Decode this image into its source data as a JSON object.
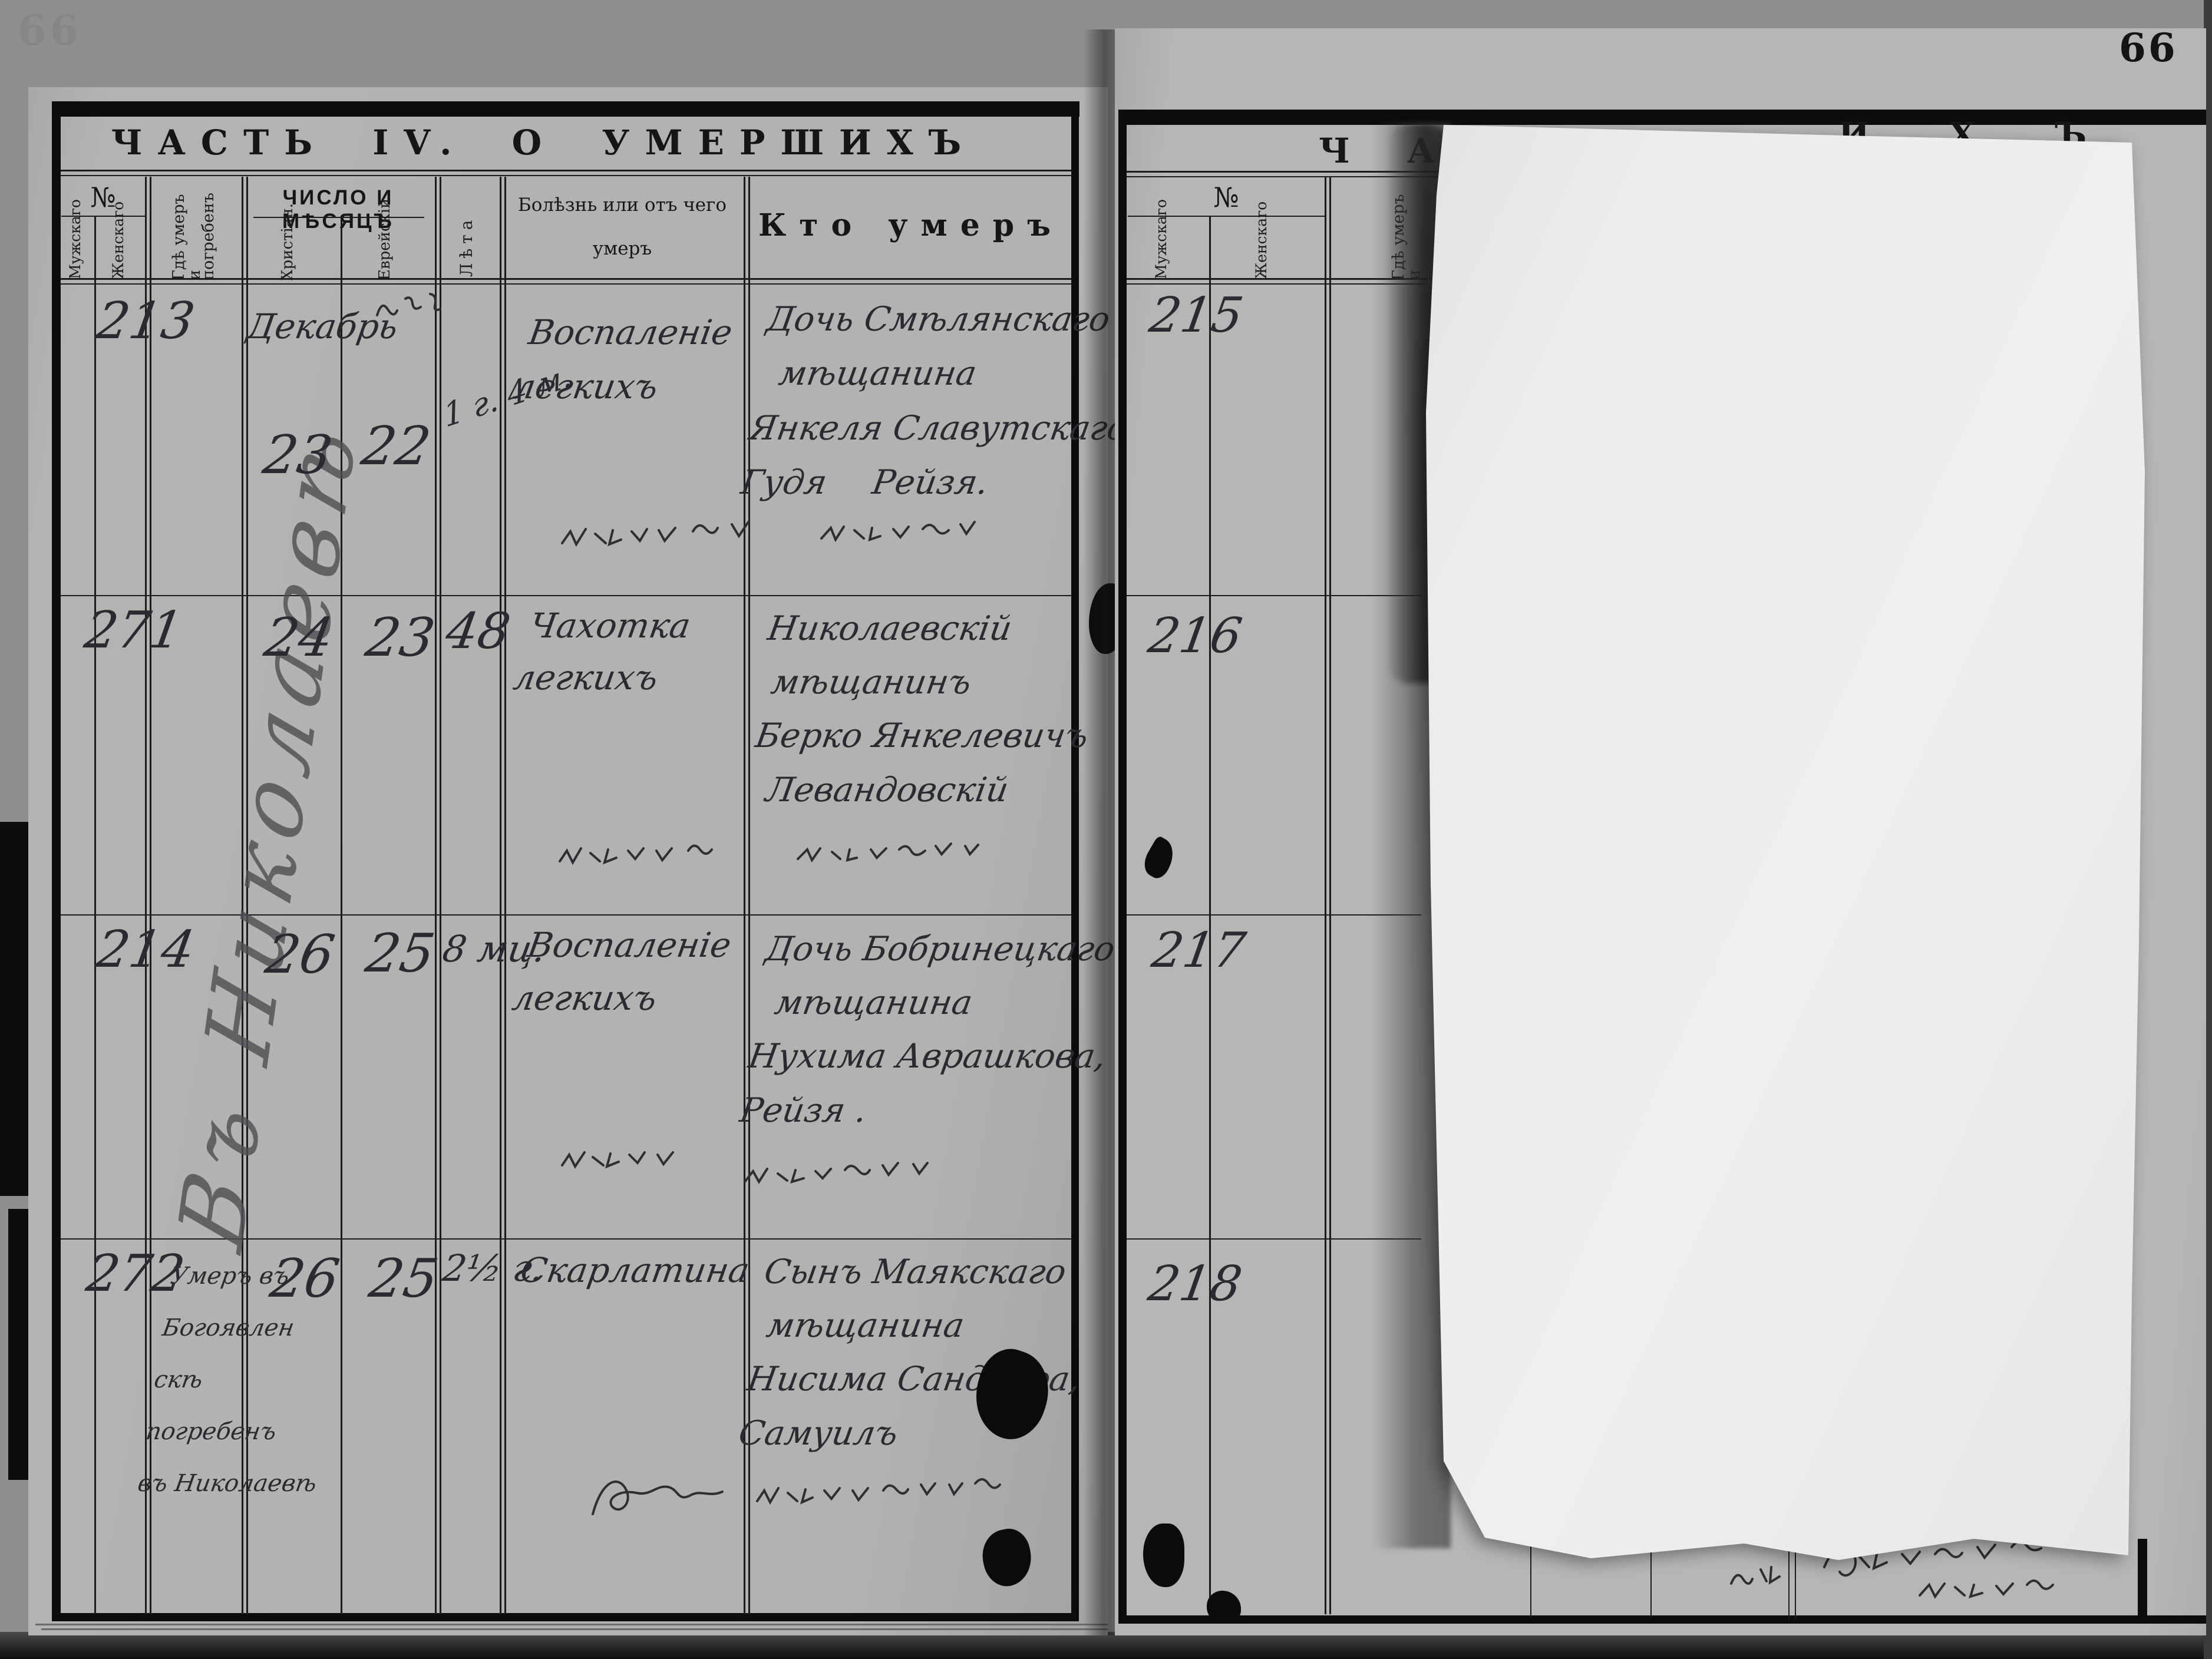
{
  "scan": {
    "page_number": "66"
  },
  "left_page": {
    "title": "ЧАСТЬ IV.  О  УМЕРШИХЪ",
    "header": {
      "no": "№",
      "male": "Мужскаго",
      "female": "Женскаго",
      "place_line1": "Гдѣ умеръ и",
      "place_line2": "погребенъ",
      "date_group": "ЧИСЛО И МѢСЯЦЪ",
      "date_christian": "Христіан.",
      "date_jewish": "Еврейскій",
      "age": "Лѣта",
      "cause_line1": "Болѣзнь или отъ чего",
      "cause_line2": "умеръ",
      "who": "Кто умеръ"
    },
    "marginal_note": "Въ Николаевѣ",
    "rows": [
      {
        "no": "213",
        "month": "Декабрь",
        "date_christian": "23",
        "date_jewish": "22",
        "age": "1 г. 4 м.",
        "cause_line1": "Воспаленіе",
        "cause_line2": "легкихъ",
        "who_line1": "Дочь Смѣлянскаго",
        "who_line2": "мѣщанина",
        "who_line3": "Янкеля Славутскаго,",
        "who_line4": "Гудя   Рейзя."
      },
      {
        "no": "271",
        "month": "",
        "date_christian": "24",
        "date_jewish": "23",
        "age": "48",
        "cause_line1": "Чахотка",
        "cause_line2": "легкихъ",
        "who_line1": "Николаевскій",
        "who_line2": "мѣщанинъ",
        "who_line3": "Берко Янкелевичъ",
        "who_line4": "Левандовскій"
      },
      {
        "no": "214",
        "month": "",
        "date_christian": "26",
        "date_jewish": "25",
        "age": "8 мц.",
        "cause_line1": "Воспаленіе",
        "cause_line2": "легкихъ",
        "who_line1": "Дочь Бобринецкаго",
        "who_line2": "мѣщанина",
        "who_line3": "Нухима Аврашкова,",
        "who_line4": "Рейзя ."
      },
      {
        "no": "272",
        "month": "",
        "date_christian": "26",
        "date_jewish": "25",
        "age": "2½ г.",
        "cause_line1": "Скарлатина",
        "cause_line2": "",
        "who_line1": "Сынъ Маякскаго",
        "who_line2": "мѣщанина",
        "who_line3": "Нисима Сандлера,",
        "who_line4": "Самуилъ",
        "place_line1": "Умеръ въ",
        "place_line2": "Богоявлен",
        "place_line3": "скѣ",
        "place_line4": "погребенъ",
        "place_line5": "въ Николаевѣ"
      }
    ]
  },
  "right_page": {
    "title_fragment_start": "Ч",
    "title_fragment_a": "А",
    "title_fragment_end": "И Х Ъ",
    "header": {
      "no": "№",
      "male": "Мужскаго",
      "female": "Женскаго",
      "place": "Гдѣ умеръ и"
    },
    "row_numbers": {
      "r1": "215",
      "r2": "216",
      "r3": "217",
      "r4": "218"
    }
  }
}
